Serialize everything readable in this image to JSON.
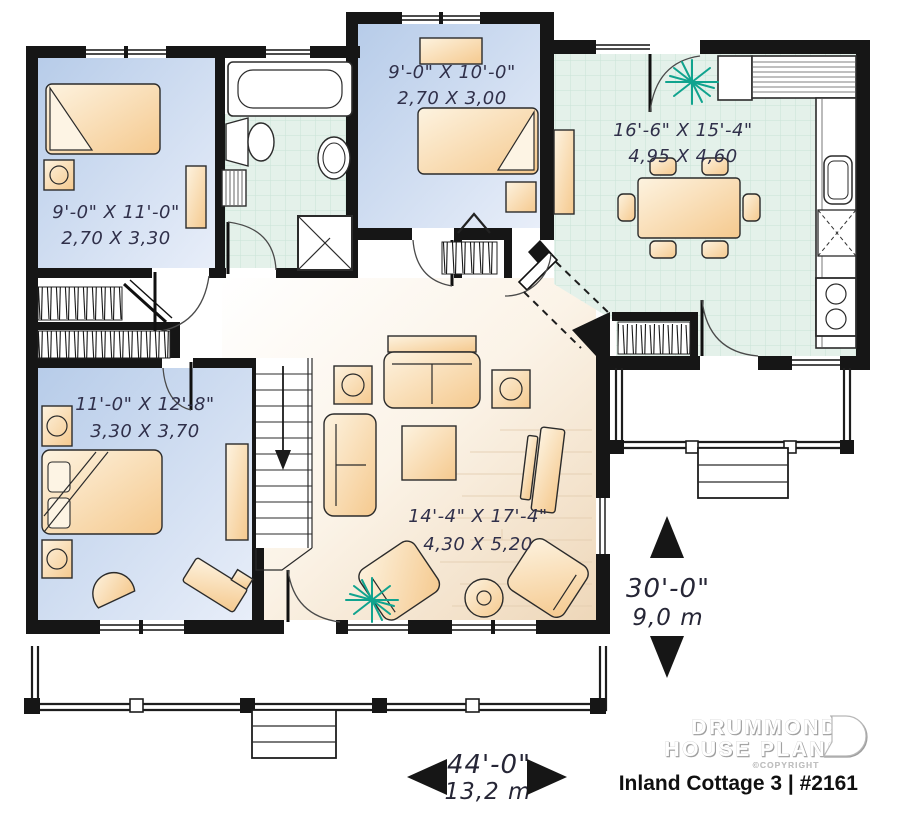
{
  "plan": {
    "title": "Inland Cottage 3 | #2161",
    "brand": {
      "line1": "DRUMMOND",
      "line2": "HOUSE PLANS",
      "copyright": "©COPYRIGHT"
    },
    "rooms": [
      {
        "id": "bedroom-top-left",
        "imperial": "9'-0\" X 11'-0\"",
        "metric": "2,70 X 3,30"
      },
      {
        "id": "bedroom-top-middle",
        "imperial": "9'-0\" X 10'-0\"",
        "metric": "2,70 X 3,00"
      },
      {
        "id": "kitchen-dining",
        "imperial": "16'-6\" X 15'-4\"",
        "metric": "4,95 X 4,60"
      },
      {
        "id": "bedroom-bottom-left",
        "imperial": "11'-0\" X 12'-8\"",
        "metric": "3,30 X 3,70"
      },
      {
        "id": "living-room",
        "imperial": "14'-4\" X 17'-4\"",
        "metric": "4,30 X 5,20"
      }
    ],
    "dimensions": {
      "depth_imperial": "30'-0\"",
      "depth_metric": "9,0 m",
      "width_imperial": "44'-0\"",
      "width_metric": "13,2 m"
    },
    "icons": [
      "plant-icon",
      "dimension-arrow-up-icon",
      "dimension-arrow-down-icon",
      "dimension-arrow-left-icon",
      "dimension-arrow-right-icon",
      "drummond-logo-mark-icon"
    ],
    "colors": {
      "walls": "#161616",
      "bedroom_floor": "#c9d7ee",
      "tile_floor": "#e4f1ea",
      "wood_floor": "#eed7b9",
      "furniture": "#f5c98e",
      "plant_green": "#10a38e"
    }
  }
}
